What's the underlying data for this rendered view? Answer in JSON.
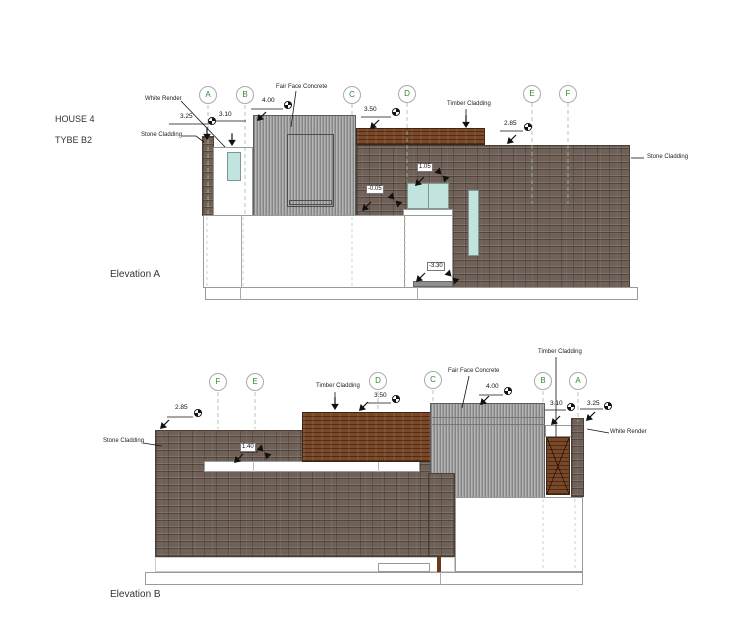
{
  "project": {
    "house": "HOUSE 4",
    "type": "TYBE B2"
  },
  "elevation_a": {
    "title": "Elevation A",
    "grid_letters": [
      "A",
      "B",
      "C",
      "D",
      "E",
      "F"
    ],
    "material_labels": {
      "white_render": "White Render",
      "stone_cladding_left": "Stone Cladding",
      "fair_face_concrete": "Fair Face Concrete",
      "timber_cladding": "Timber Cladding",
      "stone_cladding_right": "Stone Cladding"
    },
    "dimensions": {
      "d325": "3.25",
      "d310": "3.10",
      "d400": "4.00",
      "d350": "3.50",
      "d285": "2.85"
    },
    "levels": {
      "l105": "1.05",
      "lm005": "-0.05",
      "lm330": "-3.30"
    }
  },
  "elevation_b": {
    "title": "Elevation B",
    "grid_letters": [
      "F",
      "E",
      "D",
      "C",
      "B",
      "A"
    ],
    "material_labels": {
      "stone_cladding": "Stone Cladding",
      "timber_cladding_left": "Timber Cladding",
      "fair_face_concrete": "Fair Face Concrete",
      "timber_cladding_right": "Timber Cladding",
      "white_render": "White Render"
    },
    "dimensions": {
      "d285": "2.85",
      "d350": "3.50",
      "d400": "4.00",
      "d310": "3.10",
      "d325": "3.25"
    },
    "levels": {
      "l140": "1.40"
    }
  },
  "colors": {
    "stone": "#6f6158",
    "timber": "#7a4827",
    "fair_face_concrete": "#a9a9a9",
    "glass": "#c2e4df",
    "grid_letter_green": "#2e8b2e"
  }
}
